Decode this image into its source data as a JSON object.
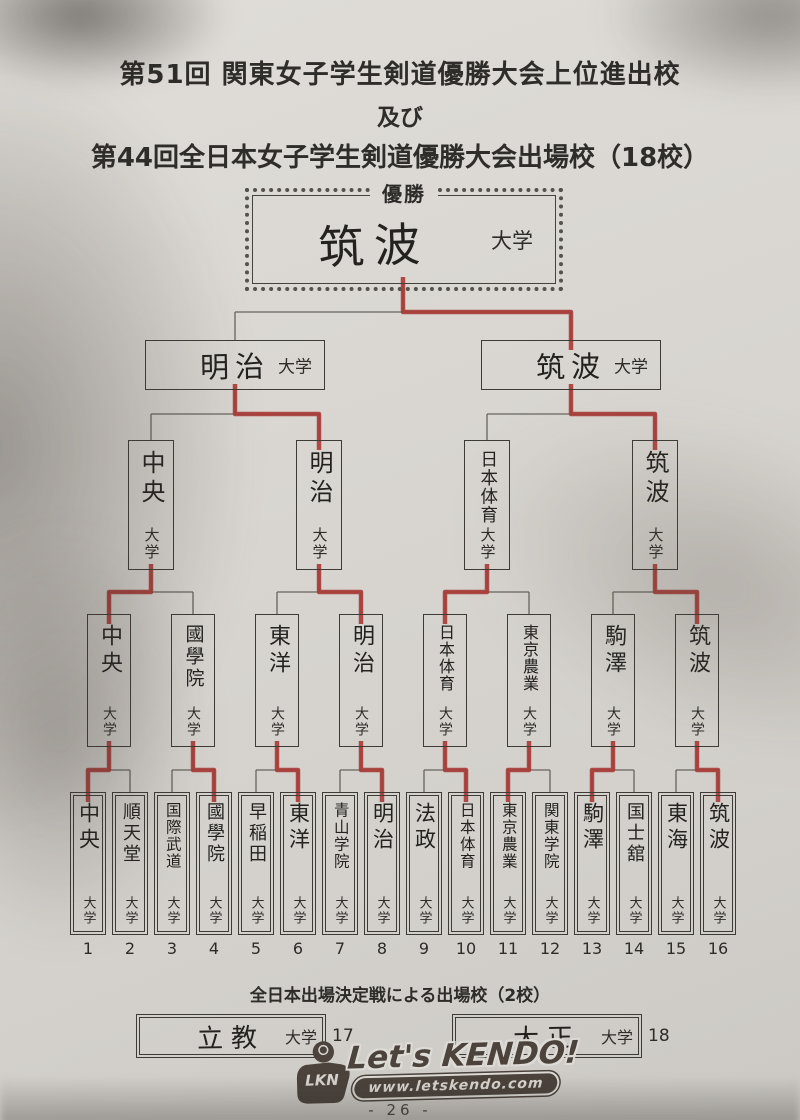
{
  "title": {
    "line1": "第51回 関東女子学生剣道優勝大会上位進出校",
    "line2": "及び",
    "line3": "第44回全日本女子学生剣道優勝大会出場校（18校）"
  },
  "champion": {
    "label": "優勝",
    "name": "筑波",
    "suffix": "大学"
  },
  "semifinals": [
    {
      "name": "明治",
      "suffix": "大学"
    },
    {
      "name": "筑波",
      "suffix": "大学"
    }
  ],
  "quarterfinals": [
    {
      "name": "中央",
      "suffix": "大学"
    },
    {
      "name": "明治",
      "suffix": "大学"
    },
    {
      "name": "日本体育",
      "suffix": "大学"
    },
    {
      "name": "筑波",
      "suffix": "大学"
    }
  ],
  "round_of_8": [
    {
      "name": "中央",
      "suffix": "大学"
    },
    {
      "name": "國學院",
      "suffix": "大学"
    },
    {
      "name": "東洋",
      "suffix": "大学"
    },
    {
      "name": "明治",
      "suffix": "大学"
    },
    {
      "name": "日本体育",
      "suffix": "大学"
    },
    {
      "name": "東京農業",
      "suffix": "大学"
    },
    {
      "name": "駒澤",
      "suffix": "大学"
    },
    {
      "name": "筑波",
      "suffix": "大学"
    }
  ],
  "round_of_16": [
    {
      "num": "1",
      "name": "中央",
      "suffix": "大学"
    },
    {
      "num": "2",
      "name": "順天堂",
      "suffix": "大学"
    },
    {
      "num": "3",
      "name": "国際武道",
      "suffix": "大学"
    },
    {
      "num": "4",
      "name": "國學院",
      "suffix": "大学"
    },
    {
      "num": "5",
      "name": "早稲田",
      "suffix": "大学"
    },
    {
      "num": "6",
      "name": "東洋",
      "suffix": "大学"
    },
    {
      "num": "7",
      "name": "青山学院",
      "suffix": "大学"
    },
    {
      "num": "8",
      "name": "明治",
      "suffix": "大学"
    },
    {
      "num": "9",
      "name": "法政",
      "suffix": "大学"
    },
    {
      "num": "10",
      "name": "日本体育",
      "suffix": "大学"
    },
    {
      "num": "11",
      "name": "東京農業",
      "suffix": "大学"
    },
    {
      "num": "12",
      "name": "関東学院",
      "suffix": "大学"
    },
    {
      "num": "13",
      "name": "駒澤",
      "suffix": "大学"
    },
    {
      "num": "14",
      "name": "国士舘",
      "suffix": "大学"
    },
    {
      "num": "15",
      "name": "東海",
      "suffix": "大学"
    },
    {
      "num": "16",
      "name": "筑波",
      "suffix": "大学"
    }
  ],
  "results": {
    "final_winner": 1,
    "semi_winners": [
      1,
      1
    ],
    "qf_winners": [
      0,
      1,
      0,
      1
    ],
    "r8_winners": [
      0,
      1,
      1,
      1,
      1,
      0,
      0,
      1
    ]
  },
  "playoff": {
    "caption": "全日本出場決定戦による出場校（2校）",
    "entries": [
      {
        "num": "17",
        "name": "立教",
        "suffix": "大学"
      },
      {
        "num": "18",
        "name": "大正",
        "suffix": "大学"
      }
    ]
  },
  "footer": {
    "badge": "LKN",
    "brand": "Let's KENDO!",
    "url": "www.letskendo.com",
    "page": "- 26 -"
  },
  "colors": {
    "accent_red": "#a93a35",
    "line_gray": "#67635d",
    "paper": "#d8d5d0",
    "ink": "#2e2c29"
  }
}
